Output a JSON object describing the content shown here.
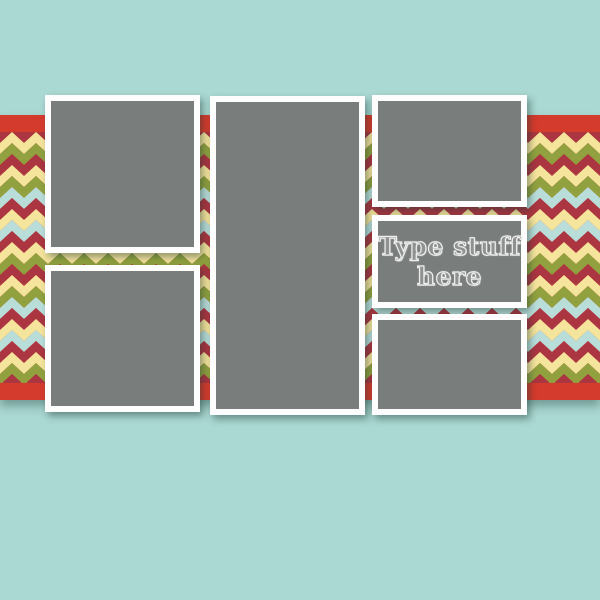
{
  "colors": {
    "background_teal": "#aad8d2",
    "band_red": "#d53b2d",
    "chevron_stripes": [
      "#f5e49c",
      "#91a13f",
      "#ab3540",
      "#f5e49c",
      "#91a13f",
      "#b9ddd9",
      "#ab3540",
      "#f5e49c",
      "#b9ddd9",
      "#ab3540"
    ],
    "placeholder_gray": "#797d7b",
    "frame_white": "#fdfdfd",
    "placeholder_text_color": "#8f9290"
  },
  "chevron": {
    "wavelength": 24,
    "stripe_height": 11
  },
  "text_placeholder": {
    "line1": "Type stuff",
    "line2": "here"
  },
  "placeholders": {
    "left_top": "photo drop zone",
    "left_bottom": "photo drop zone",
    "middle": "photo drop zone",
    "right_top": "photo drop zone",
    "right_text": "text zone",
    "right_bottom": "photo drop zone"
  }
}
